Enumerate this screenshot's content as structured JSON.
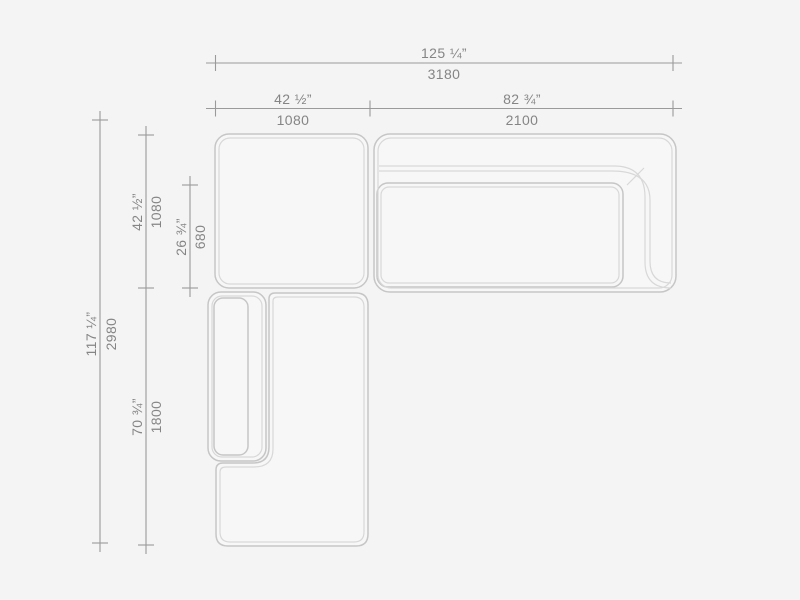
{
  "canvas": {
    "background": "#f4f4f4",
    "content": "sectional-sofa-top-view-dimension-drawing"
  },
  "style": {
    "module_fill": "#f7f7f7",
    "outline_color": "#c6c6c6",
    "inner_line_color": "#d8d8d8",
    "dim_line_color": "#9a9a9a",
    "text_color": "#858585"
  },
  "dimensions": {
    "top_total": {
      "inches": "125 ¼”",
      "mm": "3180"
    },
    "top_left": {
      "inches": "42 ½”",
      "mm": "1080"
    },
    "top_right": {
      "inches": "82 ¾”",
      "mm": "2100"
    },
    "side_total": {
      "inches": "117 ¼”",
      "mm": "2980"
    },
    "side_upper": {
      "inches": "42 ½”",
      "mm": "1080"
    },
    "seat_depth": {
      "inches": "26 ¾”",
      "mm": "680"
    },
    "side_lower": {
      "inches": "70 ¾”",
      "mm": "1800"
    }
  }
}
